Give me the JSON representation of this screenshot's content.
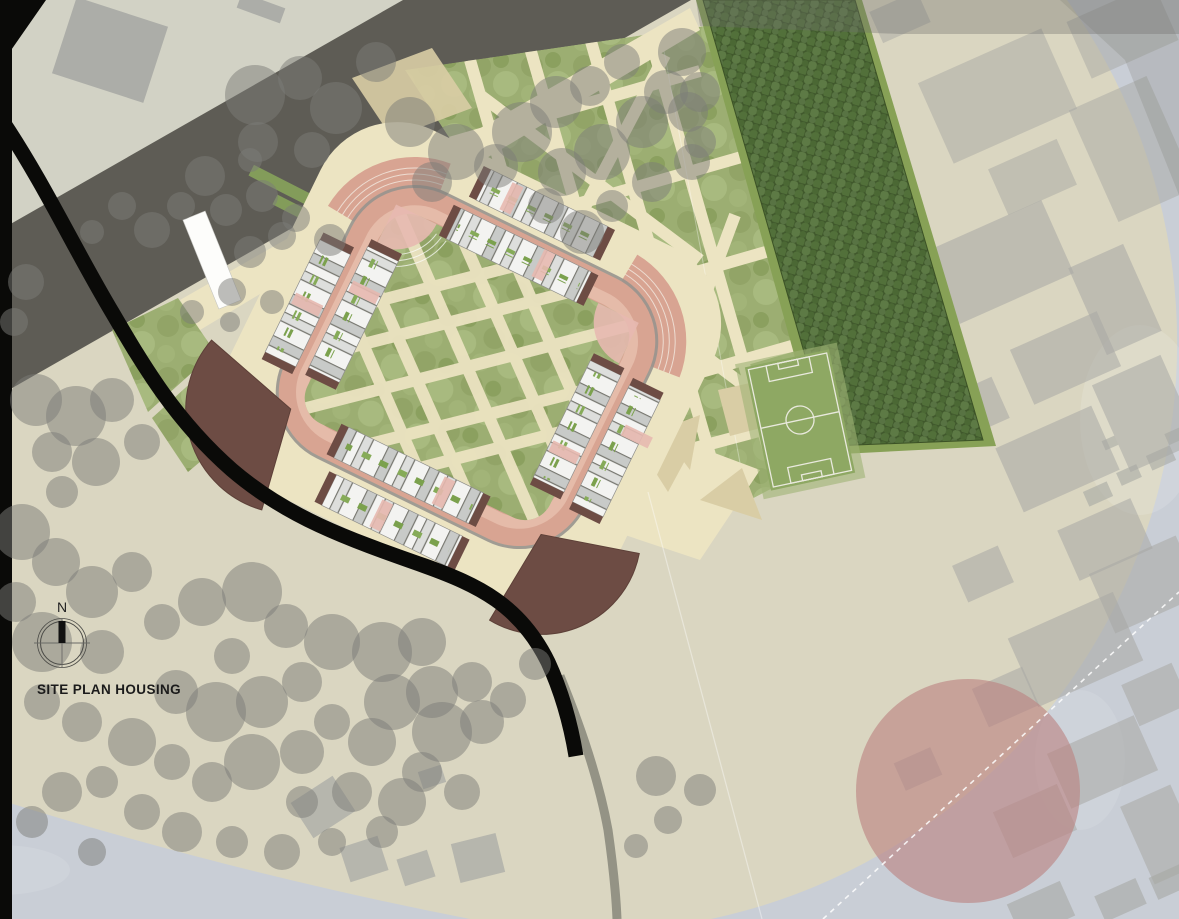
{
  "title": {
    "text": "SITE PLAN HOUSING"
  },
  "compass": {
    "north_label": "N"
  },
  "palette": {
    "bg_site": "#dad6c1",
    "bg_outside": "#c9ced6",
    "bg_upper_left": "#d2d2c5",
    "road_dark": "#5e5c55",
    "road_black": "#0a0a08",
    "road_gray": "#8c8c7e",
    "path_cream": "#ece4c2",
    "path_tan": "#d9cda5",
    "grass_green": "#9cae72",
    "orchard_green": "#40582c",
    "ring_road_pink": "#d8a492",
    "ring_road_light": "#e8c0af",
    "housing_white": "#f3f3f1",
    "housing_gray": "#c8cac8",
    "garden_strip_green": "#7ba14d",
    "fan_brown": "#6d4c44",
    "accent_pink": "#e7b9b0",
    "tree_gray": "#7b7c78",
    "building_gray": "#a7a8a4",
    "field_green": "#8ea863",
    "focus_circle_pink": "#bc8381",
    "line_white": "#ffffff"
  },
  "map_features": {
    "trees": [
      [
        255,
        95,
        30
      ],
      [
        300,
        78,
        22
      ],
      [
        336,
        108,
        26
      ],
      [
        376,
        62,
        20
      ],
      [
        258,
        142,
        20
      ],
      [
        312,
        150,
        18
      ],
      [
        410,
        122,
        25
      ],
      [
        456,
        152,
        28
      ],
      [
        432,
        182,
        20
      ],
      [
        496,
        166,
        22
      ],
      [
        522,
        132,
        30
      ],
      [
        556,
        102,
        26
      ],
      [
        590,
        86,
        20
      ],
      [
        562,
        172,
        24
      ],
      [
        602,
        152,
        28
      ],
      [
        642,
        122,
        26
      ],
      [
        666,
        92,
        22
      ],
      [
        622,
        62,
        18
      ],
      [
        682,
        52,
        24
      ],
      [
        700,
        92,
        20
      ],
      [
        546,
        206,
        18
      ],
      [
        582,
        232,
        22
      ],
      [
        612,
        206,
        16
      ],
      [
        652,
        182,
        20
      ],
      [
        692,
        162,
        18
      ],
      [
        688,
        112,
        20
      ],
      [
        700,
        142,
        16
      ],
      [
        205,
        176,
        20
      ],
      [
        226,
        210,
        16
      ],
      [
        181,
        206,
        14
      ],
      [
        152,
        230,
        18
      ],
      [
        122,
        206,
        14
      ],
      [
        92,
        232,
        12
      ],
      [
        250,
        252,
        16
      ],
      [
        282,
        236,
        14
      ],
      [
        232,
        292,
        14
      ],
      [
        272,
        302,
        12
      ],
      [
        230,
        322,
        10
      ],
      [
        192,
        312,
        12
      ],
      [
        26,
        282,
        18
      ],
      [
        14,
        322,
        14
      ],
      [
        262,
        196,
        16
      ],
      [
        296,
        218,
        14
      ],
      [
        330,
        240,
        16
      ],
      [
        250,
        160,
        12
      ],
      [
        36,
        400,
        26
      ],
      [
        76,
        416,
        30
      ],
      [
        112,
        400,
        22
      ],
      [
        52,
        452,
        20
      ],
      [
        96,
        462,
        24
      ],
      [
        142,
        442,
        18
      ],
      [
        62,
        492,
        16
      ],
      [
        22,
        532,
        28
      ],
      [
        56,
        562,
        24
      ],
      [
        16,
        602,
        20
      ],
      [
        92,
        592,
        26
      ],
      [
        132,
        572,
        20
      ],
      [
        42,
        642,
        30
      ],
      [
        102,
        652,
        22
      ],
      [
        162,
        622,
        18
      ],
      [
        202,
        602,
        24
      ],
      [
        252,
        592,
        30
      ],
      [
        286,
        626,
        22
      ],
      [
        232,
        656,
        18
      ],
      [
        332,
        642,
        28
      ],
      [
        382,
        652,
        30
      ],
      [
        422,
        642,
        24
      ],
      [
        302,
        682,
        20
      ],
      [
        262,
        702,
        26
      ],
      [
        216,
        712,
        30
      ],
      [
        176,
        692,
        22
      ],
      [
        392,
        702,
        28
      ],
      [
        432,
        692,
        26
      ],
      [
        472,
        682,
        20
      ],
      [
        332,
        722,
        18
      ],
      [
        372,
        742,
        24
      ],
      [
        302,
        752,
        22
      ],
      [
        252,
        762,
        28
      ],
      [
        212,
        782,
        20
      ],
      [
        172,
        762,
        18
      ],
      [
        132,
        742,
        24
      ],
      [
        82,
        722,
        20
      ],
      [
        42,
        702,
        18
      ],
      [
        442,
        732,
        30
      ],
      [
        482,
        722,
        22
      ],
      [
        422,
        772,
        20
      ],
      [
        462,
        792,
        18
      ],
      [
        402,
        802,
        24
      ],
      [
        352,
        792,
        20
      ],
      [
        302,
        802,
        16
      ],
      [
        102,
        782,
        16
      ],
      [
        62,
        792,
        20
      ],
      [
        32,
        822,
        16
      ],
      [
        142,
        812,
        18
      ],
      [
        182,
        832,
        20
      ],
      [
        232,
        842,
        16
      ],
      [
        282,
        852,
        18
      ],
      [
        332,
        842,
        14
      ],
      [
        382,
        832,
        16
      ],
      [
        92,
        852,
        14
      ],
      [
        508,
        700,
        18
      ],
      [
        535,
        664,
        16
      ],
      [
        656,
        776,
        20
      ],
      [
        700,
        790,
        16
      ],
      [
        668,
        820,
        14
      ],
      [
        636,
        846,
        12
      ]
    ],
    "buildings": [
      [
        62,
        10,
        96,
        80,
        18,
        0.9
      ],
      [
        238,
        0,
        46,
        16,
        20,
        0.9
      ],
      [
        930,
        52,
        135,
        88,
        -24,
        0.5
      ],
      [
        1075,
        0,
        95,
        62,
        -24,
        0.5
      ],
      [
        874,
        0,
        52,
        34,
        -24,
        0.5
      ],
      [
        1090,
        88,
        85,
        122,
        -24,
        0.5
      ],
      [
        995,
        152,
        75,
        50,
        -24,
        0.5
      ],
      [
        938,
        222,
        125,
        80,
        -24,
        0.55
      ],
      [
        1085,
        252,
        60,
        95,
        -24,
        0.55
      ],
      [
        1018,
        328,
        95,
        60,
        -24,
        0.55
      ],
      [
        948,
        386,
        55,
        45,
        -24,
        0.55
      ],
      [
        1108,
        366,
        75,
        95,
        -24,
        0.55
      ],
      [
        1005,
        424,
        105,
        70,
        -24,
        0.55
      ],
      [
        1065,
        512,
        80,
        55,
        -24,
        0.55
      ],
      [
        958,
        554,
        50,
        40,
        -24,
        0.55
      ],
      [
        1098,
        552,
        95,
        65,
        -24,
        0.55
      ],
      [
        1018,
        612,
        115,
        75,
        -24,
        0.55
      ],
      [
        1128,
        672,
        55,
        45,
        -24,
        0.55
      ],
      [
        978,
        676,
        55,
        42,
        -24,
        0.55
      ],
      [
        1055,
        732,
        95,
        60,
        -24,
        0.55
      ],
      [
        1135,
        792,
        55,
        85,
        -24,
        0.55
      ],
      [
        1000,
        796,
        70,
        50,
        -24,
        0.55
      ],
      [
        898,
        754,
        40,
        30,
        -24,
        0.55
      ],
      [
        1098,
        886,
        45,
        28,
        -24,
        0.6
      ],
      [
        1152,
        870,
        34,
        24,
        -24,
        0.6
      ],
      [
        1012,
        891,
        58,
        38,
        -24,
        0.6
      ],
      [
        1085,
        486,
        26,
        16,
        -24,
        0.6
      ],
      [
        1118,
        468,
        22,
        14,
        -24,
        0.6
      ],
      [
        1148,
        450,
        26,
        16,
        -24,
        0.6
      ],
      [
        1166,
        430,
        18,
        12,
        -24,
        0.6
      ],
      [
        1103,
        438,
        14,
        10,
        -24,
        0.6
      ],
      [
        298,
        786,
        50,
        42,
        -33,
        0.7
      ],
      [
        344,
        841,
        40,
        36,
        -18,
        0.7
      ],
      [
        400,
        854,
        32,
        28,
        -18,
        0.7
      ],
      [
        455,
        838,
        46,
        40,
        -14,
        0.7
      ],
      [
        420,
        768,
        24,
        18,
        -18,
        0.7
      ]
    ]
  }
}
